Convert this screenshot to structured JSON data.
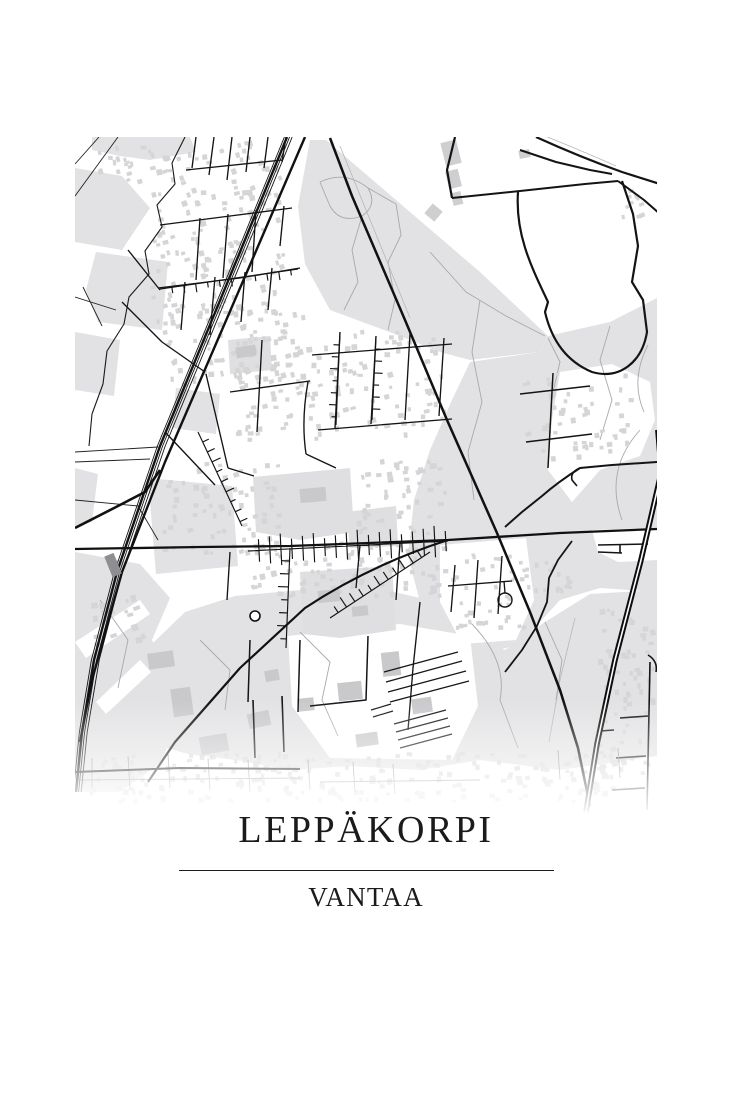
{
  "poster": {
    "title": "LEPPÄKORPI",
    "subtitle": "VANTAA",
    "background": "#ffffff",
    "text_color": "#1b1b1b",
    "divider_color": "#1c1c1c"
  },
  "map": {
    "frame": {
      "x": 75,
      "y": 137,
      "width": 582,
      "height": 700
    },
    "colors": {
      "land": "#ffffff",
      "forest": "#e2e2e4",
      "park": "#dfdfe1",
      "building": "#d5d5d7",
      "building_large": "#c9c9cc",
      "road": "#141414",
      "trail": "#a9a9ad",
      "station": "#8f8f93"
    },
    "layers": [
      {
        "t": "poly",
        "d": "M92,137 L190,137 L196,152 L150,160 L120,156 L92,150 Z",
        "f": "#e2e2e4"
      },
      {
        "t": "poly",
        "d": "M75,168 L122,176 L150,208 L122,250 L75,242 Z",
        "f": "#e2e2e4"
      },
      {
        "t": "poly",
        "d": "M96,252 L168,262 L162,330 L98,322 L86,290 Z",
        "f": "#e2e2e4"
      },
      {
        "t": "poly",
        "d": "M75,332 L120,340 L114,396 L75,390 Z",
        "f": "#e2e2e4"
      },
      {
        "t": "poly",
        "d": "M75,468 L98,474 L92,522 L75,526 Z",
        "f": "#e2e2e4"
      },
      {
        "t": "poly",
        "d": "M310,140 L326,140 L480,272 L548,336 L540,352 L470,360 L440,352 L395,334 L330,310 L305,264 L298,206 Z",
        "f": "#e2e2e4"
      },
      {
        "t": "poly",
        "d": "M548,336 L610,322 L657,298 L657,592 L600,588 L560,600 L520,644 L478,656 L446,640 L420,602 L408,556 L414,500 L430,450 L452,400 L470,362 L540,352 Z",
        "f": "#e2e2e4"
      },
      {
        "t": "poly",
        "d": "M176,388 L220,394 L216,434 L172,428 Z",
        "f": "#e2e2e4"
      },
      {
        "t": "poly",
        "d": "M148,478 L232,486 L238,566 L156,574 Z",
        "f": "#e2e2e4"
      },
      {
        "t": "poly",
        "d": "M75,552 L140,564 L170,598 L152,640 L182,700 L162,762 L120,792 L75,792 Z",
        "f": "#e2e2e4"
      },
      {
        "t": "poly",
        "d": "M75,642 L140,600 L150,614 L86,658 Z",
        "f": "#ffffff"
      },
      {
        "t": "poly",
        "d": "M96,702 L140,660 L151,672 L106,714 Z",
        "f": "#ffffff"
      },
      {
        "t": "poly",
        "d": "M235,596 L300,590 L360,584 L420,598 L455,636 L505,650 L545,622 L590,594 L657,590 L657,756 L560,770 L480,760 L420,770 L350,766 L290,770 L235,760 L188,754 L152,744 L168,700 L152,644 L185,612 Z",
        "f": "#e2e2e4"
      },
      {
        "t": "poly",
        "d": "M560,372 L612,364 L650,382 L655,420 L640,456 L600,470 L572,502 L548,470 L552,420 Z",
        "f": "#ffffff"
      },
      {
        "t": "poly",
        "d": "M592,530 L657,528 L657,560 L618,562 L598,552 Z",
        "f": "#ffffff"
      },
      {
        "t": "poly",
        "d": "M440,545 L526,538 L534,600 L516,640 L462,644 L440,602 Z",
        "f": "#ffffff"
      },
      {
        "t": "poly",
        "d": "M288,636 L400,624 L470,636 L478,706 L452,760 L330,758 L292,706 Z",
        "f": "#ffffff"
      },
      {
        "t": "poly",
        "d": "M253,477 L350,468 L354,532 L300,540 L256,532 Z",
        "f": "#dfdfe1"
      },
      {
        "t": "poly",
        "d": "M300,572 L392,566 L396,630 L340,638 L303,634 Z",
        "f": "#dfdfe1"
      },
      {
        "t": "poly",
        "d": "M346,512 L396,506 L398,546 L350,548 Z",
        "f": "#dfdfe1"
      },
      {
        "t": "poly",
        "d": "M228,340 L270,336 L272,370 L230,374 Z",
        "f": "#dfdfe1"
      },
      {
        "t": "line",
        "d": "M320,182 Q345,170 368,188 Q378,205 362,216 Q340,224 330,206 Q324,192 320,182",
        "s": "#a9a9ad",
        "w": 0.9
      },
      {
        "t": "line",
        "d": "M368,188 L396,204 L401,235 L388,262 L395,300 L388,330",
        "s": "#a9a9ad",
        "w": 0.9
      },
      {
        "t": "line",
        "d": "M362,216 L352,250 L358,282 L344,310",
        "s": "#a9a9ad",
        "w": 0.9
      },
      {
        "t": "line",
        "d": "M430,252 L466,292 L506,316 L545,336",
        "s": "#a9a9ad",
        "w": 0.9
      },
      {
        "t": "line",
        "d": "M480,300 L472,352 L482,402 L468,452 L474,500",
        "s": "#a9a9ad",
        "w": 0.9
      },
      {
        "t": "line",
        "d": "M548,338 L560,362 L552,396 M610,326 L600,360 L612,400 L600,440",
        "s": "#a9a9ad",
        "w": 0.9
      },
      {
        "t": "line",
        "d": "M640,430 Q604,470 622,520 M648,345 Q630,380 644,412",
        "s": "#a9a9ad",
        "w": 0.9
      },
      {
        "t": "line",
        "d": "M300,632 L330,662 L322,700 L338,736 M470,622 Q508,660 500,700 L518,748 M545,622 L562,660 L556,700",
        "s": "#a9a9ad",
        "w": 0.9
      },
      {
        "t": "line",
        "d": "M100,600 L128,640 L118,688 M200,640 L230,670 L225,710",
        "s": "#a9a9ad",
        "w": 0.9
      },
      {
        "t": "line",
        "d": "M340,146 L410,318",
        "s": "#b7b7ba",
        "w": 0.8
      },
      {
        "t": "line",
        "d": "M540,134 Q580,150 616,166",
        "s": "#b7b7ba",
        "w": 0.8
      },
      {
        "t": "line",
        "d": "M575,618 L560,680 L549,742",
        "s": "#b7b7ba",
        "w": 0.8
      },
      {
        "t": "rects",
        "r": [
          150,
          140,
          135,
          180
        ],
        "n": 150,
        "min": 3,
        "max": 6,
        "rot": -12,
        "f": "#d5d5d7",
        "seed": 11
      },
      {
        "t": "rects",
        "r": [
          95,
          140,
          58,
          44
        ],
        "n": 18,
        "min": 3,
        "max": 6,
        "rot": -12,
        "f": "#d5d5d7",
        "seed": 12
      },
      {
        "t": "rects",
        "r": [
          152,
          300,
          160,
          88
        ],
        "n": 80,
        "min": 3,
        "max": 6,
        "rot": -10,
        "f": "#d5d5d7",
        "seed": 13
      },
      {
        "t": "rects",
        "r": [
          235,
          330,
          215,
          112
        ],
        "n": 140,
        "min": 3,
        "max": 6,
        "rot": -8,
        "f": "#d5d5d7",
        "seed": 14
      },
      {
        "t": "rects",
        "r": [
          160,
          462,
          125,
          98
        ],
        "n": 75,
        "min": 3,
        "max": 6,
        "rot": -8,
        "f": "#d5d5d7",
        "seed": 15
      },
      {
        "t": "rects",
        "r": [
          250,
          540,
          200,
          58
        ],
        "n": 85,
        "min": 3,
        "max": 6,
        "rot": -6,
        "f": "#d5d5d7",
        "seed": 16
      },
      {
        "t": "rects",
        "r": [
          355,
          458,
          95,
          80
        ],
        "n": 50,
        "min": 3,
        "max": 6,
        "rot": -6,
        "f": "#d5d5d7",
        "seed": 17
      },
      {
        "t": "rects",
        "r": [
          448,
          548,
          85,
          85
        ],
        "n": 42,
        "min": 3,
        "max": 5,
        "rot": -4,
        "f": "#d5d5d7",
        "seed": 18
      },
      {
        "t": "rects",
        "r": [
          598,
          606,
          58,
          168
        ],
        "n": 60,
        "min": 3,
        "max": 6,
        "rot": -6,
        "f": "#d5d5d7",
        "seed": 19
      },
      {
        "t": "rects",
        "r": [
          80,
          752,
          575,
          52
        ],
        "n": 220,
        "min": 3,
        "max": 6,
        "rot": 0,
        "f": "#d5d5d7",
        "seed": 20,
        "o": 0.95
      },
      {
        "t": "rects",
        "r": [
          520,
          372,
          118,
          92
        ],
        "n": 50,
        "min": 3,
        "max": 6,
        "rot": -4,
        "f": "#d5d5d7",
        "seed": 21
      },
      {
        "t": "rects",
        "r": [
          620,
          188,
          34,
          38
        ],
        "n": 10,
        "min": 3,
        "max": 6,
        "rot": -10,
        "f": "#d5d5d7",
        "seed": 22
      },
      {
        "t": "rects",
        "r": [
          90,
          595,
          58,
          52
        ],
        "n": 16,
        "min": 3,
        "max": 7,
        "rot": -14,
        "f": "#d5d5d7",
        "seed": 23
      },
      {
        "t": "rects",
        "r": [
          520,
          560,
          54,
          36
        ],
        "n": 18,
        "min": 3,
        "max": 5,
        "rot": -4,
        "f": "#d5d5d7",
        "seed": 24
      },
      {
        "t": "brects",
        "list": [
          [
            443,
            141,
            16,
            24,
            -14
          ],
          [
            447,
            170,
            13,
            18,
            -14
          ],
          [
            452,
            192,
            10,
            13,
            -14
          ],
          [
            427,
            206,
            13,
            13,
            40
          ],
          [
            519,
            150,
            11,
            8,
            -12
          ]
        ],
        "f": "#cfcfd1"
      },
      {
        "t": "brects",
        "list": [
          [
            148,
            652,
            26,
            16,
            -8
          ],
          [
            172,
            688,
            20,
            28,
            -8
          ],
          [
            200,
            735,
            28,
            18,
            -10
          ],
          [
            248,
            712,
            22,
            15,
            -12
          ],
          [
            338,
            682,
            24,
            18,
            -6
          ],
          [
            382,
            652,
            18,
            24,
            -6
          ],
          [
            412,
            698,
            20,
            15,
            -8
          ],
          [
            356,
            733,
            22,
            13,
            -8
          ],
          [
            298,
            698,
            16,
            13,
            -6
          ],
          [
            265,
            670,
            14,
            11,
            -10
          ]
        ],
        "f": "#c9c9cc"
      },
      {
        "t": "brects",
        "list": [
          [
            236,
            346,
            20,
            11,
            -8
          ],
          [
            300,
            488,
            26,
            14,
            -5
          ],
          [
            318,
            590,
            22,
            12,
            -6
          ],
          [
            352,
            606,
            16,
            10,
            -6
          ]
        ],
        "f": "#c9c9cc"
      },
      {
        "t": "line",
        "d": "M384,672 L458,652 M386,682 L462,661 M388,692 L466,671 M390,702 L469,681 M394,724 L446,710 M396,732 L448,718 M398,740 L450,726 M400,748 L452,734 M371,710 L391,704 M373,717 L393,711",
        "s": "#161616",
        "w": 1.2
      },
      {
        "t": "line",
        "d": "M75,452 L158,447 M75,462 L150,459 M75,500 L138,506 L158,540 M75,297 L116,310 M83,287 L102,326 M118,137 L75,196 M99,137 L75,164",
        "s": "#222222",
        "w": 0.9
      },
      {
        "t": "line",
        "d": "M185,137 L172,163 L175,184 L157,205 L162,227 L145,251 L149,274 L129,297 L124,324 L107,351 L103,384 L92,414 L89,446",
        "s": "#1a1a1a",
        "w": 1.1
      },
      {
        "t": "line",
        "d": "M196,137 L192,168 M214,137 L209,175 M232,137 L227,180 M250,137 L246,172 M268,137 L264,168 M286,137 L282,162 M186,170 L282,160 M160,225 L230,216 L292,208 M200,218 L196,280 M228,214 L223,278 M256,210 L252,272 M284,206 L280,246 M158,288 L240,278 L300,268 M185,282 L181,330 M215,277 L210,335 M245,272 L241,322 M272,268 L268,310 M128,250 L160,290 M122,302 L162,342 L205,372",
        "s": "#141414",
        "w": 1.35
      },
      {
        "t": "line",
        "d": "M312,355 L452,344 M340,332 L335,428 M376,336 L371,424 M410,334 L405,420 M444,338 L439,416 M230,392 L310,381 M318,430 L452,419 M308,382 Q301,420 306,454 M306,454 L336,468 M262,340 L257,432 M206,374 L228,468 M228,468 L254,476 M165,432 L215,485",
        "s": "#141414",
        "w": 1.35
      },
      {
        "t": "line",
        "d": "M230,552 L227,600 M360,545 L356,588 M400,543 L396,600 M420,602 L413,668 L408,730",
        "s": "#141414",
        "w": 1.35
      },
      {
        "t": "line",
        "d": "M455,565 L451,612 M478,560 L474,618 M502,556 L498,614 M448,586 L512,581 M505,593 L504,581",
        "s": "#141414",
        "w": 1.35
      },
      {
        "t": "line",
        "d": "M553,373 L548,468 M520,394 L590,386 M526,442 L592,434",
        "s": "#141414",
        "w": 1.5
      },
      {
        "t": "line",
        "d": "M300,640 L298,712 M368,636 L366,700 L310,706 M250,640 L248,702",
        "s": "#141414",
        "w": 1.5
      },
      {
        "t": "line",
        "d": "M648,655 Q658,661 656,672 M650,662 L647,810 M620,718 L648,716 M616,758 L646,756 M612,790 L645,788 M600,731 L614,730",
        "s": "#141414",
        "w": 1.6
      },
      {
        "t": "line",
        "d": "M92,788 L92,758 M130,790 L128,756 M170,788 L168,754 M210,790 L208,758 M250,792 L248,760 M310,790 L308,760 M355,792 L353,762 M395,794 L393,764 M560,780 L558,750 M620,778 L618,748 M80,780 L300,778 M320,782 L480,780",
        "s": "#8e8e92",
        "w": 0.9,
        "o": 0.9
      },
      {
        "t": "comb",
        "p": [
          [
            248,
            551
          ],
          [
            448,
            541
          ]
        ],
        "tick": 15,
        "step": 11,
        "side": 0
      },
      {
        "t": "comb",
        "p": [
          [
            290,
            548
          ],
          [
            286,
            648
          ]
        ],
        "tick": 10,
        "step": 13,
        "side": 1
      },
      {
        "t": "comb",
        "p": [
          [
            430,
            552
          ],
          [
            330,
            618
          ]
        ],
        "tick": 11,
        "step": 10,
        "side": 1
      },
      {
        "t": "comb",
        "p": [
          [
            340,
            333
          ],
          [
            336,
            425
          ]
        ],
        "tick": 8,
        "step": 12,
        "side": 1
      },
      {
        "t": "comb",
        "p": [
          [
            376,
            337
          ],
          [
            372,
            420
          ]
        ],
        "tick": 8,
        "step": 12,
        "side": -1
      },
      {
        "t": "comb",
        "p": [
          [
            160,
            289
          ],
          [
            298,
            269
          ]
        ],
        "tick": 8,
        "step": 12,
        "side": 1
      },
      {
        "t": "comb",
        "p": [
          [
            198,
            432
          ],
          [
            242,
            526
          ]
        ],
        "tick": 9,
        "step": 11,
        "side": -1
      },
      {
        "t": "line",
        "d": "M455,137 L447,170 L452,198",
        "s": "#141414",
        "w": 2.2
      },
      {
        "t": "line",
        "d": "M452,198 L520,191 L585,184 L618,181",
        "s": "#141414",
        "w": 2.0
      },
      {
        "t": "line",
        "d": "M618,181 L644,200 L660,214",
        "s": "#141414",
        "w": 2.0
      },
      {
        "t": "line",
        "d": "M536,137 Q580,157 622,172 L660,184",
        "s": "#141414",
        "w": 2.2
      },
      {
        "t": "line",
        "d": "M520,150 L556,162 L590,170 L612,174",
        "s": "#141414",
        "w": 2.0
      },
      {
        "t": "line",
        "d": "M518,192 C515,235 532,268 548,302 L545,312 C552,342 568,362 592,372 C620,380 642,362 647,332 L643,300 L632,282 L638,246 L633,214 L622,181",
        "s": "#141414",
        "w": 2.2
      },
      {
        "t": "line",
        "d": "M505,527 L522,512 L542,496 Q558,482 580,468 L612,465 L657,462",
        "s": "#141414",
        "w": 2.0
      },
      {
        "t": "line",
        "d": "M580,468 Q570,472 572,480 L577,486",
        "s": "#141414",
        "w": 1.6
      },
      {
        "t": "line",
        "d": "M572,541 L558,560 L549,578 L547,602 L537,626 L522,650 L505,672",
        "s": "#141414",
        "w": 1.8
      },
      {
        "t": "line",
        "d": "M598,545 L648,544 M598,552 L622,553 M620,545 L620,553",
        "s": "#141414",
        "w": 1.6
      },
      {
        "t": "line",
        "d": "M75,549 L200,547 L290,546 L448,540 L560,533 L657,529",
        "s": "#111111",
        "w": 2.3
      },
      {
        "t": "line",
        "d": "M330,138 L352,196 L405,320 L447,420 L497,533 L530,612 L560,690 L578,748 L590,806",
        "s": "#111111",
        "w": 2.5
      },
      {
        "t": "line",
        "d": "M448,540 Q370,565 305,608 L240,668 L175,742 L148,782",
        "s": "#111111",
        "w": 2.2
      },
      {
        "t": "line",
        "d": "M253,700 L255,758 M282,696 L284,752",
        "s": "#141414",
        "w": 1.6
      },
      {
        "t": "rail",
        "d": "M287,137 L240,252 L160,446 L117,572 L94,660 L82,732 L76,792",
        "offs": [
          [
            -2.6,
            0.9
          ],
          [
            0,
            2.4
          ],
          [
            2.6,
            0.9
          ],
          [
            5.2,
            0.9
          ]
        ]
      },
      {
        "t": "line",
        "d": "M305,137 L253,258 L165,462 L122,572 L92,680 L80,742",
        "s": "#111111",
        "w": 2.4
      },
      {
        "t": "line",
        "d": "M75,528 L118,506 L145,492 L160,470",
        "s": "#111111",
        "w": 2.6
      },
      {
        "t": "brects",
        "list": [
          [
            108,
            554,
            10,
            22,
            -22
          ]
        ],
        "f": "#8f8f93"
      },
      {
        "t": "line",
        "d": "M75,772 L180,768 L300,769",
        "s": "#141414",
        "w": 2.0
      },
      {
        "t": "line",
        "d": "M656,430 L660,478",
        "s": "#0d0d0d",
        "w": 1.8
      },
      {
        "t": "line",
        "d": "M660,478 L641,560 L615,660 L597,744 L586,812",
        "s": "#0d0d0d",
        "w": 5.6
      },
      {
        "t": "line",
        "d": "M660,478 L641,560 L615,660 L597,744 L586,812",
        "s": "#ffffff",
        "w": 1.6
      },
      {
        "t": "circ",
        "cx": 255,
        "cy": 616,
        "r": 5,
        "f": "#ffffff",
        "s": "#111111",
        "w": 1.6
      },
      {
        "t": "circ",
        "cx": 505,
        "cy": 600,
        "r": 7,
        "f": "none",
        "s": "#141414",
        "w": 1.4
      }
    ]
  }
}
